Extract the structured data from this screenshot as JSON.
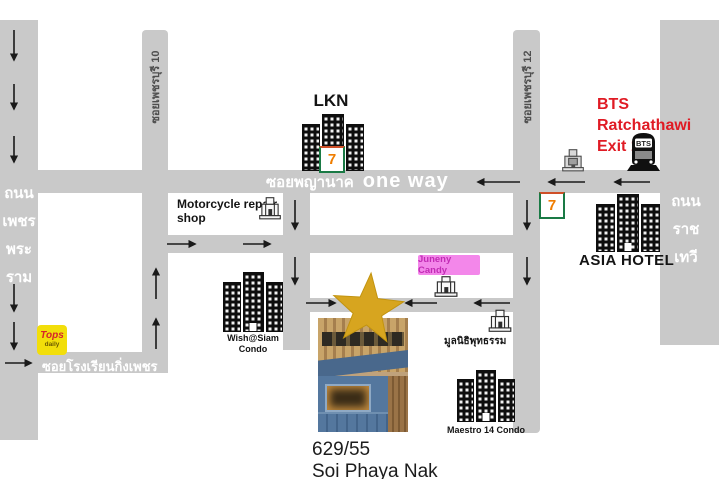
{
  "map": {
    "streets": {
      "soi_phetchaburi_10": "ซอยเพชรบุรี 10",
      "soi_phetchaburi_12": "ซอยเพชรบุรี 12",
      "soi_phaya_nak": "ซอยพญานาค",
      "one_way": "one way",
      "thanon_phet_phra_ram_lines": [
        "ถนน",
        "เพชร",
        "พระ",
        "ราม"
      ],
      "thanon_ratchathewi_lines": [
        "ถนน",
        "ราช",
        "เทวี"
      ],
      "soi_rongrian_king_phet": "ซอยโรงเรียนกิ่งเพชร"
    },
    "landmarks": {
      "lkn": {
        "label": "LKN"
      },
      "bts": {
        "line1": "BTS Ratchathawi",
        "line2": "Exit 1",
        "icon_text": "BTS"
      },
      "seven_eleven": {
        "glyph": "7"
      },
      "asia_hotel": {
        "label": "ASIA HOTEL"
      },
      "motorcycle_shop": {
        "line1": "Motorcycle repair",
        "line2": "shop"
      },
      "wish_siam": {
        "line1": "Wish@Siam",
        "line2": "Condo"
      },
      "juneny_candy": {
        "label": "Juneny Candy"
      },
      "buddhist_foundation": {
        "label": "มูลนิธิพุทธรรม"
      },
      "maestro_condo": {
        "label": "Maestro 14 Condo"
      },
      "tops_daily": {
        "line1": "Tops",
        "line2": "daily"
      }
    },
    "destination": {
      "address": "629/55",
      "street": "Soi Phaya Nak"
    },
    "colors": {
      "road": "#c9c9c9",
      "accent_red": "#e01b24",
      "star_gold": "#D7A51F",
      "candy_pink_bg": "#F387EA",
      "candy_pink_text": "#C22BB5",
      "tops_yellow": "#F2DE0A"
    }
  }
}
